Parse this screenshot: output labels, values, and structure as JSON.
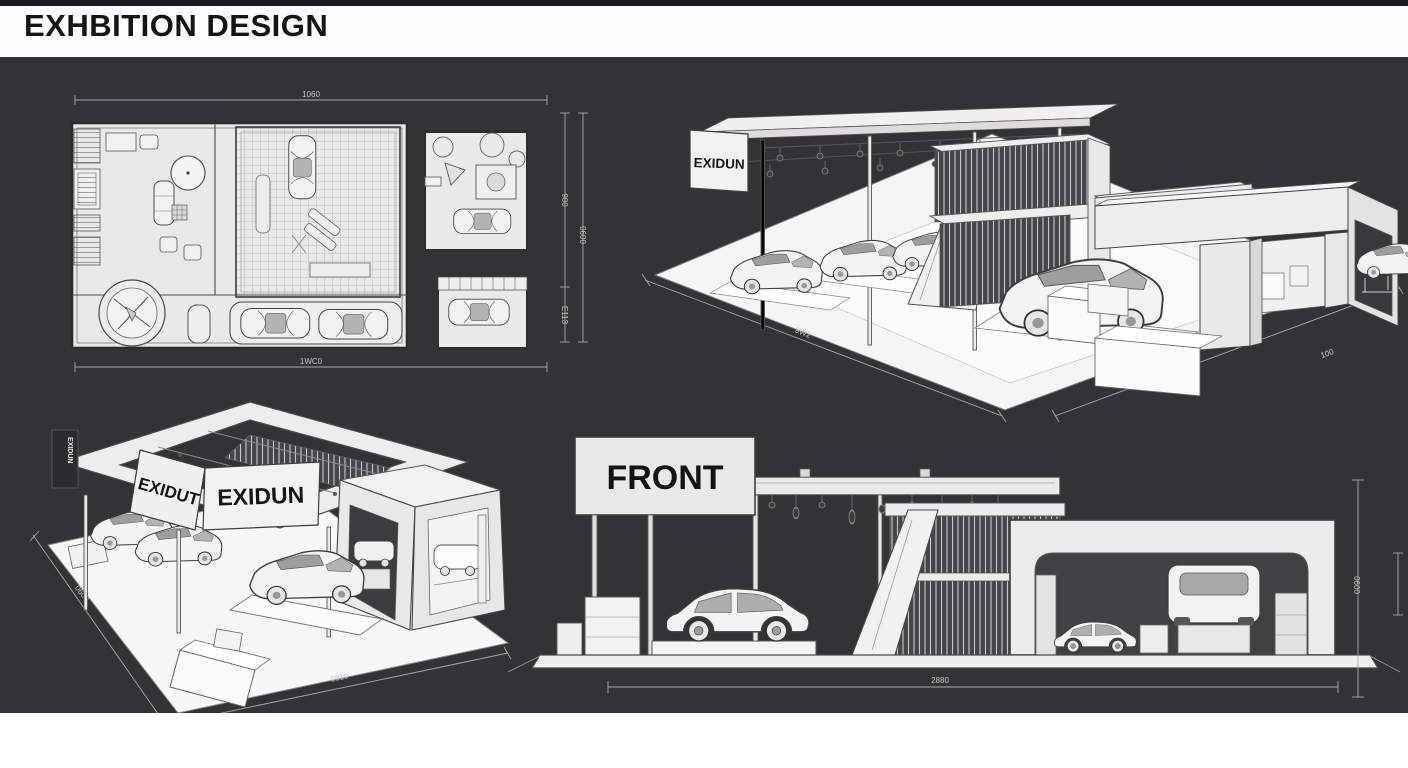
{
  "header": {
    "title": "EXHBITION DESIGN"
  },
  "colors": {
    "background": "#333336",
    "paper": "#fdfdfd",
    "drawing_fill": "#e9e9e7",
    "dim_text": "#c6c6c4",
    "line": "#3e3e3e"
  },
  "plan_view": {
    "dim_top": "1060",
    "dim_bottom": "1WC0",
    "dim_right_upper": "900",
    "dim_right_lower": "E113",
    "dim_right_outer": "0600"
  },
  "iso_main": {
    "sign": "EXIDUN",
    "dim_left": "9W2",
    "dim_right": "100"
  },
  "iso_secondary": {
    "sign_small": "EXIDUN",
    "sign_side": "EXIDUT",
    "sign_front": "EXIDUN",
    "dim_left": "0600",
    "dim_bottom": "0810"
  },
  "front_view": {
    "label": "FRONT",
    "dim_bottom": "2880",
    "dim_right": "0600"
  }
}
